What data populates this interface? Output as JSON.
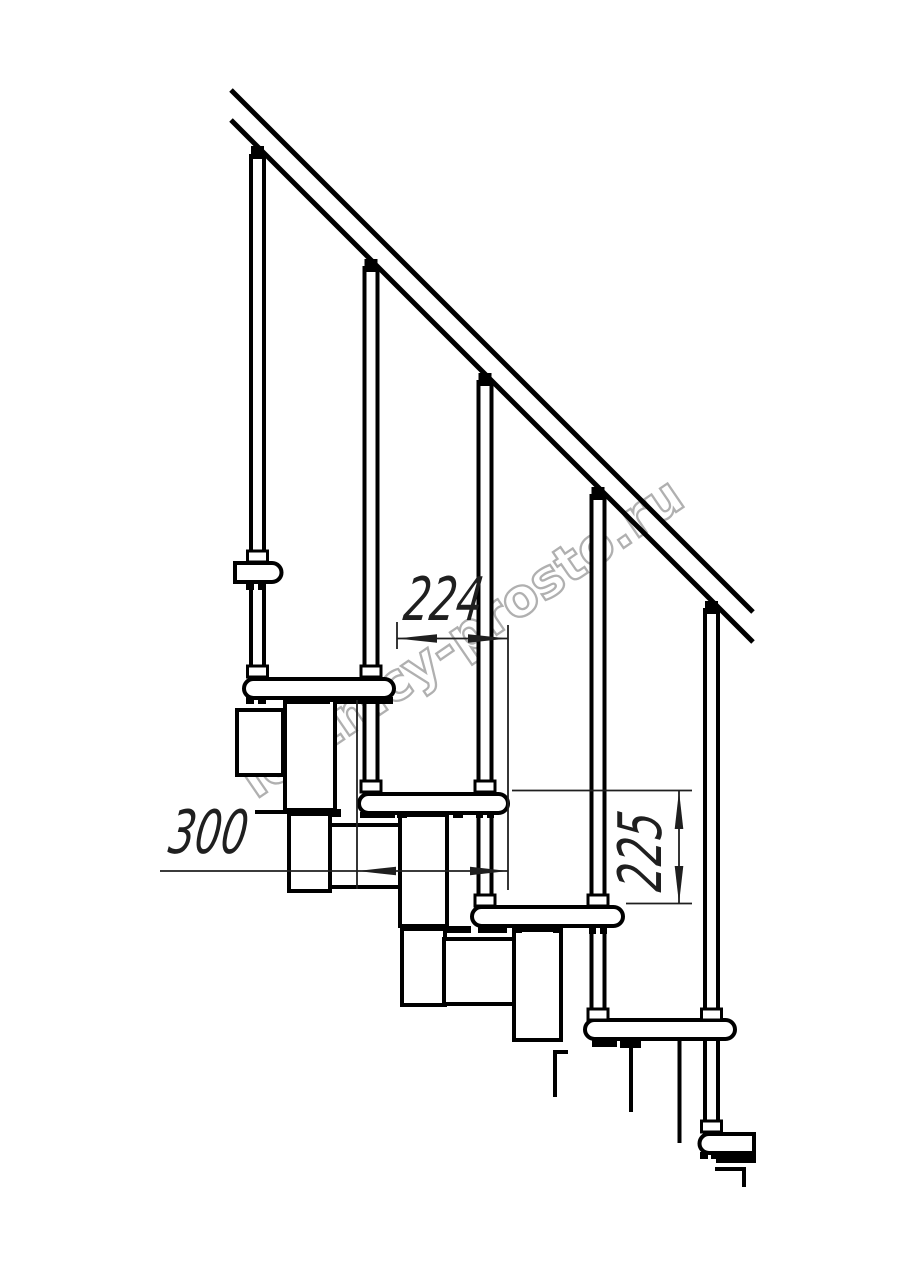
{
  "drawing": {
    "background": "#ffffff",
    "line_color": "#000000",
    "dim_line_color": "#1f1f1f"
  },
  "dimensions": {
    "run_label": "224",
    "depth_label": "300",
    "rise_label": "225"
  },
  "watermark": {
    "text": "lestnicy-prosto.ru",
    "color": "#b0b0b0"
  }
}
